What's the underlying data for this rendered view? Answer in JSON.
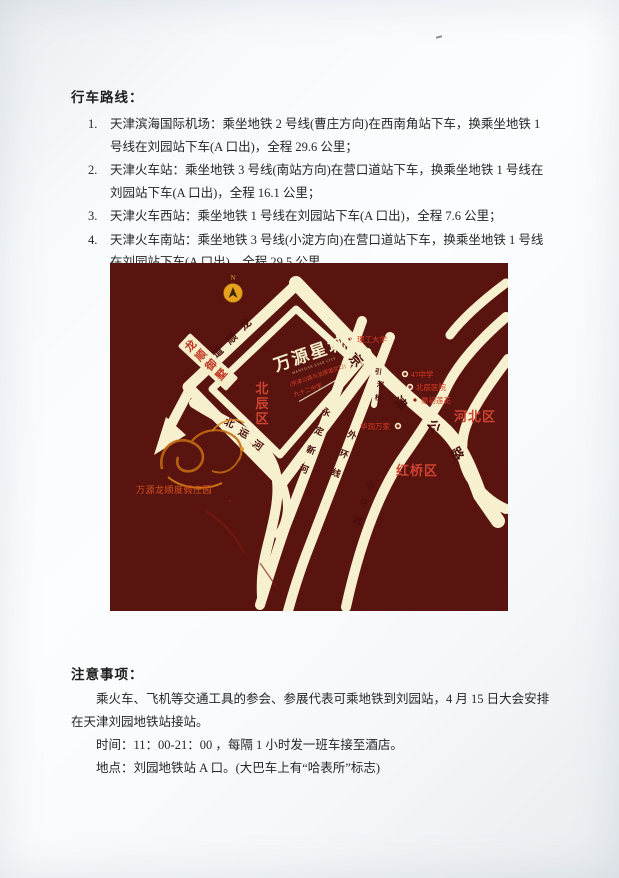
{
  "document": {
    "routes_heading": "行车路线：",
    "routes": [
      {
        "num": "1.",
        "text": "天津滨海国际机场：乘坐地铁 2 号线(曹庄方向)在西南角站下车，换乘坐地铁 1 号线在刘园站下车(A 口出)，全程 29.6 公里；"
      },
      {
        "num": "2.",
        "text": "天津火车站：乘坐地铁 3 号线(南站方向)在营口道站下车，换乘坐地铁 1 号线在刘园站下车(A 口出)，全程 16.1 公里；"
      },
      {
        "num": "3.",
        "text": "天津火车西站：乘坐地铁 1 号线在刘园站下车(A 口出)，全程 7.6 公里；"
      },
      {
        "num": "4.",
        "text": "天津火车南站：乘坐地铁 3 号线(小淀方向)在营口道站下车，换乘坐地铁 1 号线在刘园站下车(A 口出)，全程 29.5 公里。"
      }
    ],
    "notes_heading": "注意事项：",
    "notes_para1": "乘火车、飞机等交通工具的参会、参展代表可乘地铁到刘园站，4 月 15 日大会安排在天津刘园地铁站接站。",
    "notes_para2": "时间：11：00-21：00 ，每隔 1 小时发一班车接至酒店。",
    "notes_para3": "地点：刘园地铁站 A 口。(大巴车上有“哈表所”标志)"
  },
  "map": {
    "compass_n": "N",
    "logo_title": "万源星城",
    "logo_sub_en": "WANYUAN STAR CITY",
    "logo_sub_red1": "(京津公路与龙顺道交口)",
    "logo_sub_red2": "九十二中学",
    "landmark_box": "龙顺御墅",
    "roads": {
      "longshundao": "龙顺道",
      "beiyunhe": "北运河",
      "yongdingxinhe": "永定新河",
      "waihuanxian": "外环线",
      "zhonghuanxian": "中环线",
      "jingjin": "京津公路",
      "yinheqiao": "引河桥"
    },
    "districts": {
      "beichen": "北辰区",
      "hebei": "河北区",
      "hongqiao": "红桥区"
    },
    "pois": {
      "ligong": "理工大学",
      "school47": "47中学",
      "hospital": "北辰医院",
      "lotus": "易初莲花",
      "huarun": "华润万家"
    },
    "resort": "万源龙顺度假庄园"
  }
}
